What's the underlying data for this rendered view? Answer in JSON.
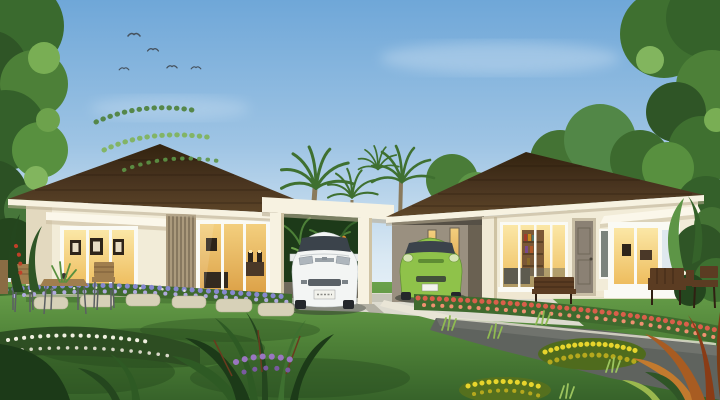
{
  "scene": {
    "type": "3D architectural rendering",
    "setting": "Two single-storey tropical houses with dark brown hip roofs and cream walls, joined by a flat-roofed double carport; landscaped garden with large lawn in front",
    "sky": {
      "condition": "clear blue with wispy clouds",
      "birds_count": 5
    },
    "left_house": {
      "roof": "dark brown hip roof",
      "walls": "cream",
      "features": [
        "picture window with 3 framed artworks",
        "warm lit interior",
        "vertical wood louver screen",
        "sliding glass door with lamps and sideboard",
        "white awning band"
      ]
    },
    "right_house": {
      "roof": "dark brown hip roof",
      "walls": "cream",
      "features": [
        "integrated carport with lit slit windows",
        "sliding glass doors with bookshelf",
        "entry door",
        "slim frosted window",
        "white bay window with warm light"
      ]
    },
    "vehicles": [
      {
        "type": "hatchback",
        "color": "white",
        "location": "central carport"
      },
      {
        "type": "hatchback",
        "color": "green",
        "location": "right-house carport"
      }
    ],
    "garden": {
      "lawn": "large green lawn with tree shadows",
      "paths": [
        "stepping stones",
        "light concrete driveway",
        "dark garden path with white curb"
      ],
      "beds": [
        "purple flower bed by left house",
        "red-orange flower hedge by right house",
        "yellow flower mounds",
        "white ground flowers",
        "orange croton foliage",
        "dark tropical leaves"
      ],
      "furniture": [
        "wood-slat table and chairs on left",
        "wooden bench center-right",
        "wooden bench right",
        "dark wood table set far right"
      ],
      "trees": [
        "large leafy tree left edge",
        "palms behind carport",
        "large tree right edge with orange blossoms",
        "background trees"
      ]
    }
  },
  "palette": {
    "cloud": "#ffffff",
    "bird": "#46525e",
    "wall": "#f2ecd8",
    "fascia": "#f7f2e1",
    "louver": "#ab9a7c",
    "door": "#8b8174",
    "slim_window": "#7b837c",
    "bookshelf": "#7b5836",
    "carport_interior": "#9a9080",
    "car_white": "#f3f5f4",
    "car_green": "#8fc24a",
    "windshield": "#3b434b",
    "plate": "#f2f2ec",
    "drive": "#dddbcf",
    "path": "#5f635e",
    "curb": "#e9e5d6",
    "stone": "#d7d1b8",
    "bed_green": "#3f6a2e",
    "flower_purple": "#8688cf",
    "flower_purple_light": "#b0aade",
    "flower_white": "#f0f0e0",
    "flower_red": "#d95f4a",
    "flower_red_light": "#ef9070",
    "flower_yellow": "#e8d52c",
    "flower_yellow_dark": "#b5a81d",
    "wood": "#a07e4e",
    "wood_dark": "#5b3c22",
    "palm": "#3f7030"
  }
}
